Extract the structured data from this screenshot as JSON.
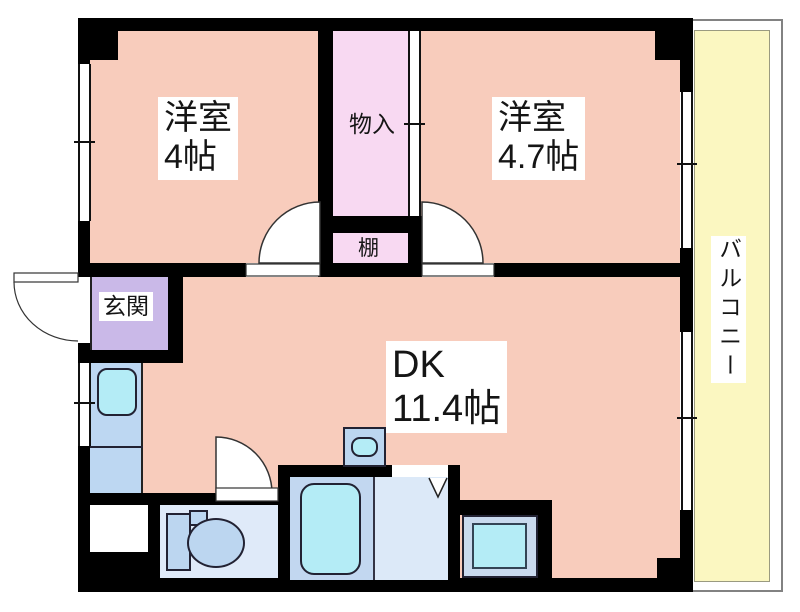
{
  "plan_title": "1DK apartment floor plan",
  "colors": {
    "wall": "#000000",
    "room": "#f8ccbc",
    "closet": "#f8d9f2",
    "entrance": "#cab9e8",
    "balcony": "#fbf7c1",
    "kitchen": "#bdd7f2",
    "cyan": "#b4ecf6",
    "toilet_floor": "#dfeaf9",
    "fixture": "#bcd6f0",
    "bath_floor": "#c2d7f0",
    "washroom_floor": "#dce9f8",
    "pan_frame": "#c9daee"
  },
  "labels": {
    "room_small": {
      "line1": "洋室",
      "line2": "4帖"
    },
    "room_large": {
      "line1": "洋室",
      "line2": "4.7帖"
    },
    "dk": {
      "line1": "DK",
      "line2": "11.4帖"
    },
    "closet": "物入",
    "shelf": "棚",
    "entrance": "玄関",
    "balcony": "バルコニー"
  },
  "fixtures": [
    "kitchen-sink",
    "washbasin",
    "bathtub",
    "toilet",
    "washing-machine-pan",
    "meter-box"
  ]
}
